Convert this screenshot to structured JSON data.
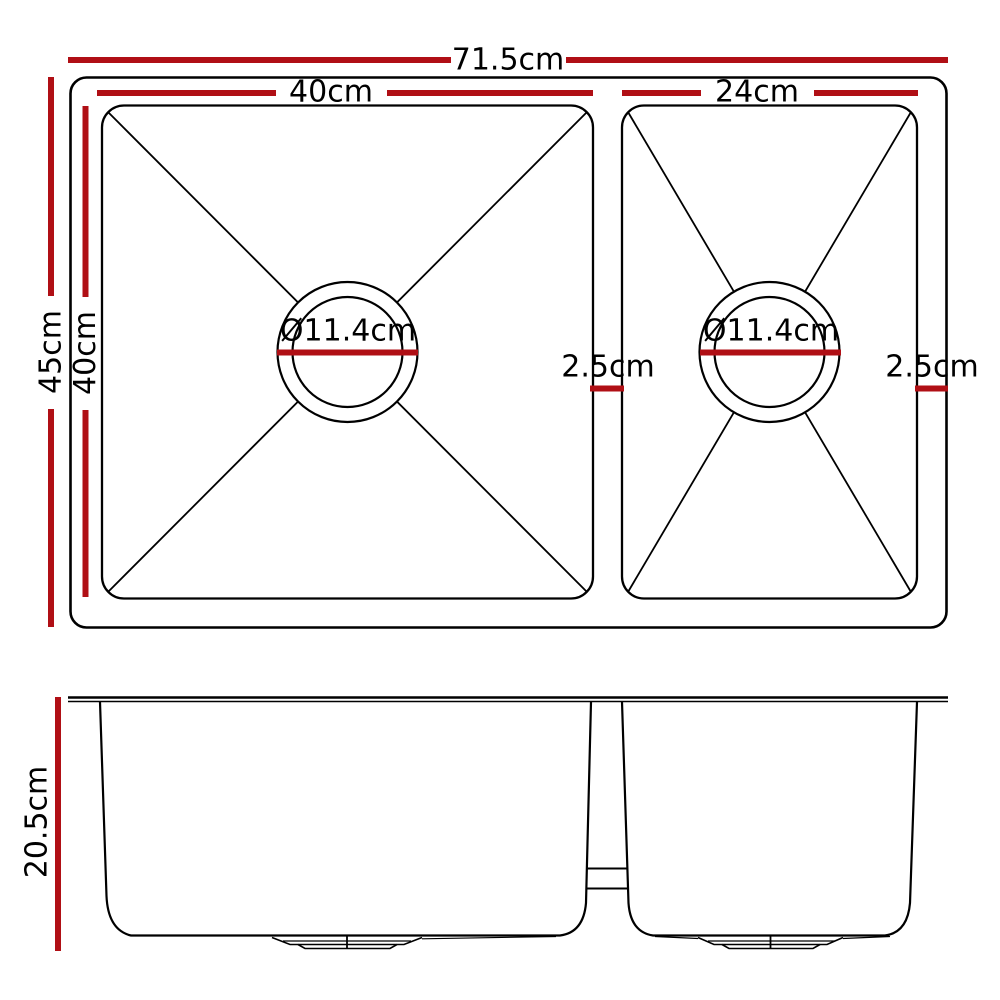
{
  "colors": {
    "dimension_red": "#b00f15",
    "outline_black": "#000000"
  },
  "top_view": {
    "overall_width_label": "71.5cm",
    "left_bowl_width_label": "40cm",
    "right_bowl_width_label": "24cm",
    "overall_depth_label": "45cm",
    "left_bowl_depth_label": "40cm",
    "left_drain_label": "Ø11.4cm",
    "right_drain_label": "Ø11.4cm",
    "divider_gap_label": "2.5cm",
    "right_gap_label": "2.5cm"
  },
  "side_view": {
    "depth_label": "20.5cm"
  }
}
